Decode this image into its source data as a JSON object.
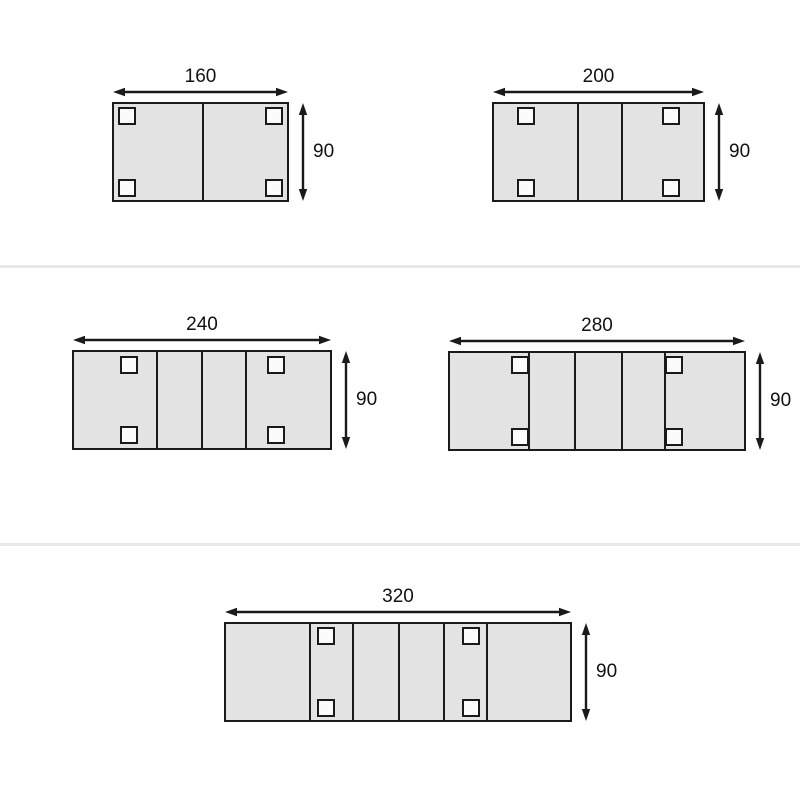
{
  "page": {
    "description": "Extendable table size diagrams, top view, five configurations with width and height dimensions"
  },
  "colors": {
    "background": "#ffffff",
    "table_fill": "#e3e3e3",
    "leg_fill": "#fbfbfb",
    "stroke": "#1a1a1a",
    "text": "#111111",
    "row_separator": "#e8e8e8"
  },
  "row_separators": [
    {
      "y": 265
    },
    {
      "y": 543
    }
  ],
  "chart_data": {
    "type": "table",
    "title": "",
    "series": [
      {
        "name": "table-160x90",
        "width_cm": 160,
        "depth_cm": 90,
        "sections": 2,
        "legs": 4
      },
      {
        "name": "table-200x90",
        "width_cm": 200,
        "depth_cm": 90,
        "sections": 3,
        "legs": 4
      },
      {
        "name": "table-240x90",
        "width_cm": 240,
        "depth_cm": 90,
        "sections": 4,
        "legs": 4
      },
      {
        "name": "table-280x90",
        "width_cm": 280,
        "depth_cm": 90,
        "sections": 5,
        "legs": 4
      },
      {
        "name": "table-320x90",
        "width_cm": 320,
        "depth_cm": 90,
        "sections": 6,
        "legs": 4
      }
    ]
  },
  "diagrams": [
    {
      "id": "table-160x90",
      "width_label": "160",
      "height_label": "90",
      "rect": {
        "x": 112,
        "y": 102,
        "w": 177,
        "h": 100
      },
      "dividers_x": [
        91
      ],
      "legs": [
        {
          "x": 6,
          "y": 5
        },
        {
          "x": 153,
          "y": 5
        },
        {
          "x": 6,
          "y": 77
        },
        {
          "x": 153,
          "y": 77
        }
      ]
    },
    {
      "id": "table-200x90",
      "width_label": "200",
      "height_label": "90",
      "rect": {
        "x": 492,
        "y": 102,
        "w": 213,
        "h": 100
      },
      "dividers_x": [
        86,
        130
      ],
      "legs": [
        {
          "x": 25,
          "y": 5
        },
        {
          "x": 170,
          "y": 5
        },
        {
          "x": 25,
          "y": 77
        },
        {
          "x": 170,
          "y": 77
        }
      ]
    },
    {
      "id": "table-240x90",
      "width_label": "240",
      "height_label": "90",
      "rect": {
        "x": 72,
        "y": 350,
        "w": 260,
        "h": 100
      },
      "dividers_x": [
        85,
        130,
        174
      ],
      "legs": [
        {
          "x": 48,
          "y": 6
        },
        {
          "x": 195,
          "y": 6
        },
        {
          "x": 48,
          "y": 76
        },
        {
          "x": 195,
          "y": 76
        }
      ]
    },
    {
      "id": "table-280x90",
      "width_label": "280",
      "height_label": "90",
      "rect": {
        "x": 448,
        "y": 351,
        "w": 298,
        "h": 100
      },
      "dividers_x": [
        81,
        127,
        174,
        217
      ],
      "legs": [
        {
          "x": 63,
          "y": 5
        },
        {
          "x": 217,
          "y": 5
        },
        {
          "x": 63,
          "y": 77
        },
        {
          "x": 217,
          "y": 77
        }
      ]
    },
    {
      "id": "table-320x90",
      "width_label": "320",
      "height_label": "90",
      "rect": {
        "x": 224,
        "y": 622,
        "w": 348,
        "h": 100
      },
      "dividers_x": [
        86,
        129,
        175,
        220,
        263
      ],
      "legs": [
        {
          "x": 93,
          "y": 5
        },
        {
          "x": 238,
          "y": 5
        },
        {
          "x": 93,
          "y": 77
        },
        {
          "x": 238,
          "y": 77
        }
      ]
    }
  ],
  "dimension_style": {
    "width_arrow_offset": 10,
    "height_arrow_offset": 14,
    "arrowhead_length": 12,
    "arrowhead_width": 8.4
  }
}
